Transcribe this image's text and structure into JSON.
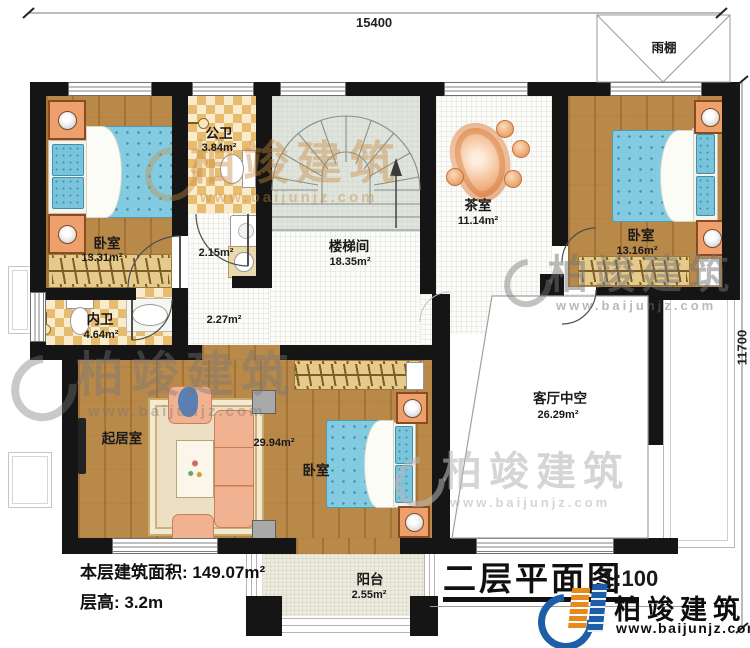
{
  "dimensions": {
    "top": "15400",
    "right": "11700"
  },
  "canopy": {
    "label": "雨棚"
  },
  "rooms": {
    "bedroom_left": {
      "name": "卧室",
      "area": "13.31m²"
    },
    "public_bath": {
      "name": "公卫",
      "area": "3.84m²"
    },
    "hall_upper": {
      "area": "2.15m²"
    },
    "hall_lower": {
      "area": "2.27m²"
    },
    "stairwell": {
      "name": "楼梯间",
      "area": "18.35m²"
    },
    "tea_room": {
      "name": "茶室",
      "area": "11.14m²"
    },
    "bedroom_right": {
      "name": "卧室",
      "area": "13.16m²"
    },
    "void_space": {
      "name": "客厅中空",
      "area": "26.29m²"
    },
    "living_room": {
      "name": "起居室"
    },
    "bedroom_master": {
      "name": "卧室",
      "area": "29.94m²"
    },
    "inner_bath": {
      "name": "内卫",
      "area": "4.64m²"
    },
    "balcony": {
      "name": "阳台",
      "area": "2.55m²"
    }
  },
  "footer": {
    "area_line": "本层建筑面积: 149.07m²",
    "height_line": "层高: 3.2m"
  },
  "title_block": {
    "title": "二层平面图",
    "scale": "1:100"
  },
  "brand": {
    "name": "柏竣建筑",
    "url": "www.baijunjz.com"
  },
  "watermark": {
    "name": "柏竣建筑",
    "url": "www.baijunjz.com"
  },
  "colors": {
    "wood": "#b5823e",
    "bath_tile": "#e7bc6e",
    "bed": "#82cbe0",
    "sofa": "#f0b291",
    "stair": "#dfe5dc",
    "wall": "#151515",
    "brand_blue": "#1c5fa8",
    "brand_orange": "#e8891c"
  }
}
